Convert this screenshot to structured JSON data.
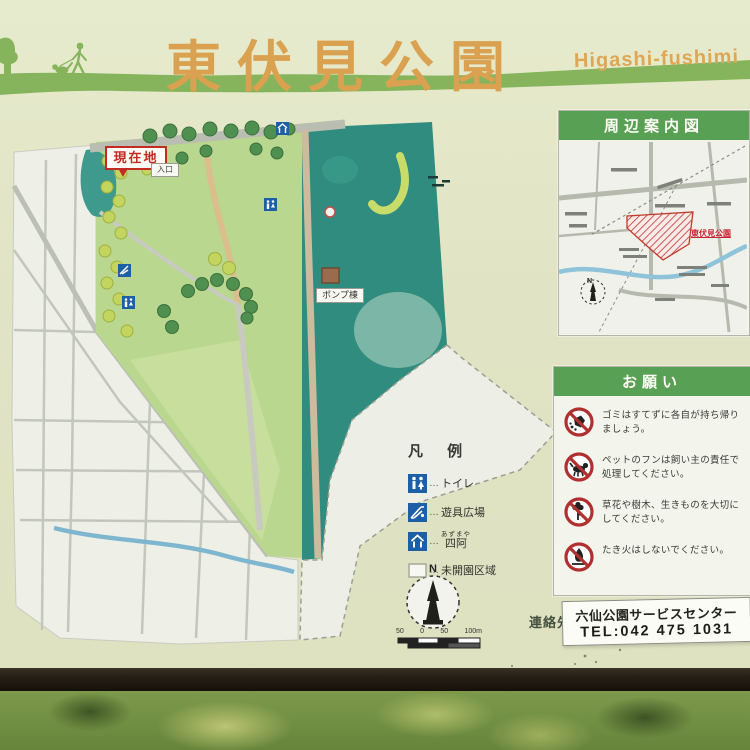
{
  "header": {
    "title": "東伏見公園",
    "romaji": "Higashi-fushimi"
  },
  "map": {
    "current_location": "現在地",
    "entrance": "入口",
    "pump_house": "ポンプ棟",
    "compass_north": "N",
    "scale_labels": [
      "50",
      "0",
      "50",
      "100m"
    ]
  },
  "legend": {
    "title": "凡 例",
    "leader": "…",
    "items": [
      {
        "icon": "toilet-icon",
        "label": "トイレ"
      },
      {
        "icon": "playground-icon",
        "label": "遊具広場"
      },
      {
        "icon": "gazebo-icon",
        "label": "四阿",
        "furigana": "あずまや"
      },
      {
        "icon": "undeveloped-area-icon",
        "label": "未開園区域"
      }
    ]
  },
  "vicinity": {
    "title": "周辺案内図",
    "park_label": "東伏見公園",
    "compass_north": "N"
  },
  "notice": {
    "title": "お願い",
    "items": [
      {
        "icon": "no-litter-icon",
        "text": "ゴミはすてずに各自が持ち帰りましょう。"
      },
      {
        "icon": "dog-waste-icon",
        "text": "ペットのフンは飼い主の責任で処理してください。"
      },
      {
        "icon": "protect-plants-icon",
        "text": "草花や樹木、生きものを大切にしてください。"
      },
      {
        "icon": "no-fire-icon",
        "text": "たき火はしないでください。"
      }
    ]
  },
  "contact": {
    "label": "連絡先",
    "name": "六仙公園サービスセンター",
    "tel": "TEL:042 475 1031"
  },
  "colors": {
    "sign_background": "#e0e4c4",
    "title_orange": "#d9a150",
    "band_green": "#86b45c",
    "panel_header_green": "#58a054",
    "park_lawn": "#b9d78f",
    "undeveloped_teal": "#2f8c7e",
    "prohibition_red": "#b03030",
    "current_location_red": "#c22a22",
    "facility_icon_blue": "#1d5fa6"
  }
}
